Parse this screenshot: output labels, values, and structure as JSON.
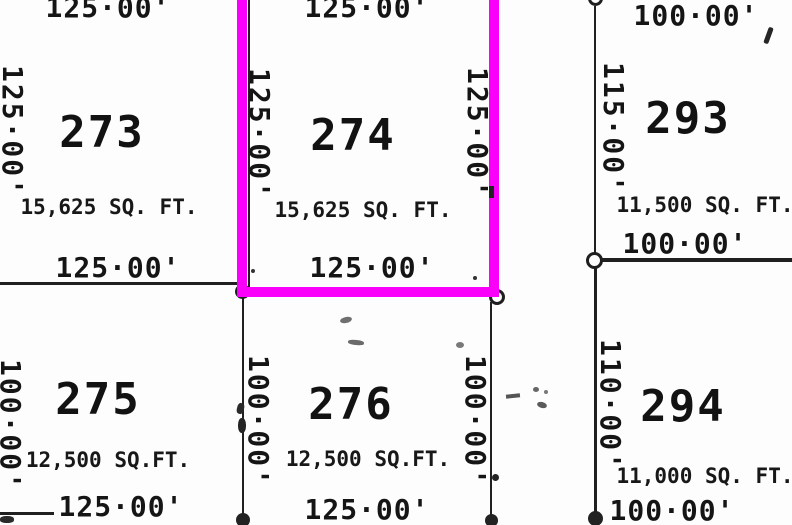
{
  "parcels": {
    "273": {
      "number": "273",
      "area": "15,625 SQ. FT.",
      "dim_top": "125·00'",
      "dim_left": "125·00'",
      "dim_bottom": "125·00'"
    },
    "274": {
      "number": "274",
      "area": "15,625 SQ. FT.",
      "dim_top": "125·00'",
      "dim_left": "125·00'",
      "dim_right": "125·00'",
      "dim_bottom": "125·00'",
      "highlighted": true
    },
    "275": {
      "number": "275",
      "area": "12,500 SQ.FT.",
      "dim_left": "100·00'",
      "dim_bottom": "125·00'"
    },
    "276": {
      "number": "276",
      "area": "12,500 SQ.FT.",
      "dim_left": "100·00'",
      "dim_right": "100·00'",
      "dim_bottom": "125·00'"
    },
    "293": {
      "number": "293",
      "area": "11,500 SQ. FT.",
      "dim_top": "100·00'",
      "dim_left": "115·00'",
      "dim_bottom": "100·00'"
    },
    "294": {
      "number": "294",
      "area": "11,000 SQ. FT.",
      "dim_left": "110·00'",
      "dim_bottom": "100·00'"
    }
  },
  "colors": {
    "ink": "#1b1b1b",
    "highlight": "#fa00fa",
    "paper": "#fdfdfd"
  }
}
